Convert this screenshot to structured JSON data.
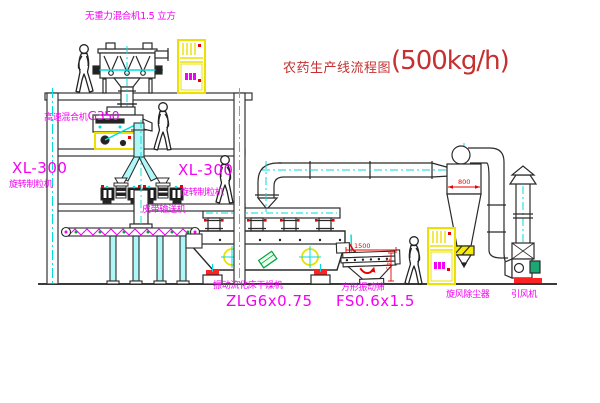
{
  "title": {
    "text": "农药生产线流程图",
    "capacity": "(500kg/h)"
  },
  "equipment_labels": {
    "gravity_mixer": "无重力混合机1.5 立方",
    "high_speed_mixer_name": "高速混合机",
    "high_speed_mixer_model": "G350",
    "granulator_left_model": "XL-300",
    "granulator_left_name": "旋转制粒机",
    "granulator_right_model": "XL-300",
    "granulator_right_name": "旋转制粒机",
    "belt_conveyor": "皮带输送机",
    "dryer_name": "振动流化床干燥机",
    "dryer_model": "ZLG6x0.75",
    "screen_name": "方形振动筛",
    "screen_model": "FS0.6x1.5",
    "cyclone": "旋风除尘器",
    "fan": "引风机"
  },
  "dimensions": {
    "screen_length": "1500",
    "screen_height": "545",
    "cyclone_dim": "800"
  },
  "colors": {
    "label_magenta": "#f400f4",
    "centerline_cyan": "#00dede",
    "dimension_red": "#e80000",
    "cabinet_yellow": "#ece000",
    "motor_green": "#00a33a",
    "title_red": "#c53030",
    "line_black": "#2a2a2a"
  }
}
